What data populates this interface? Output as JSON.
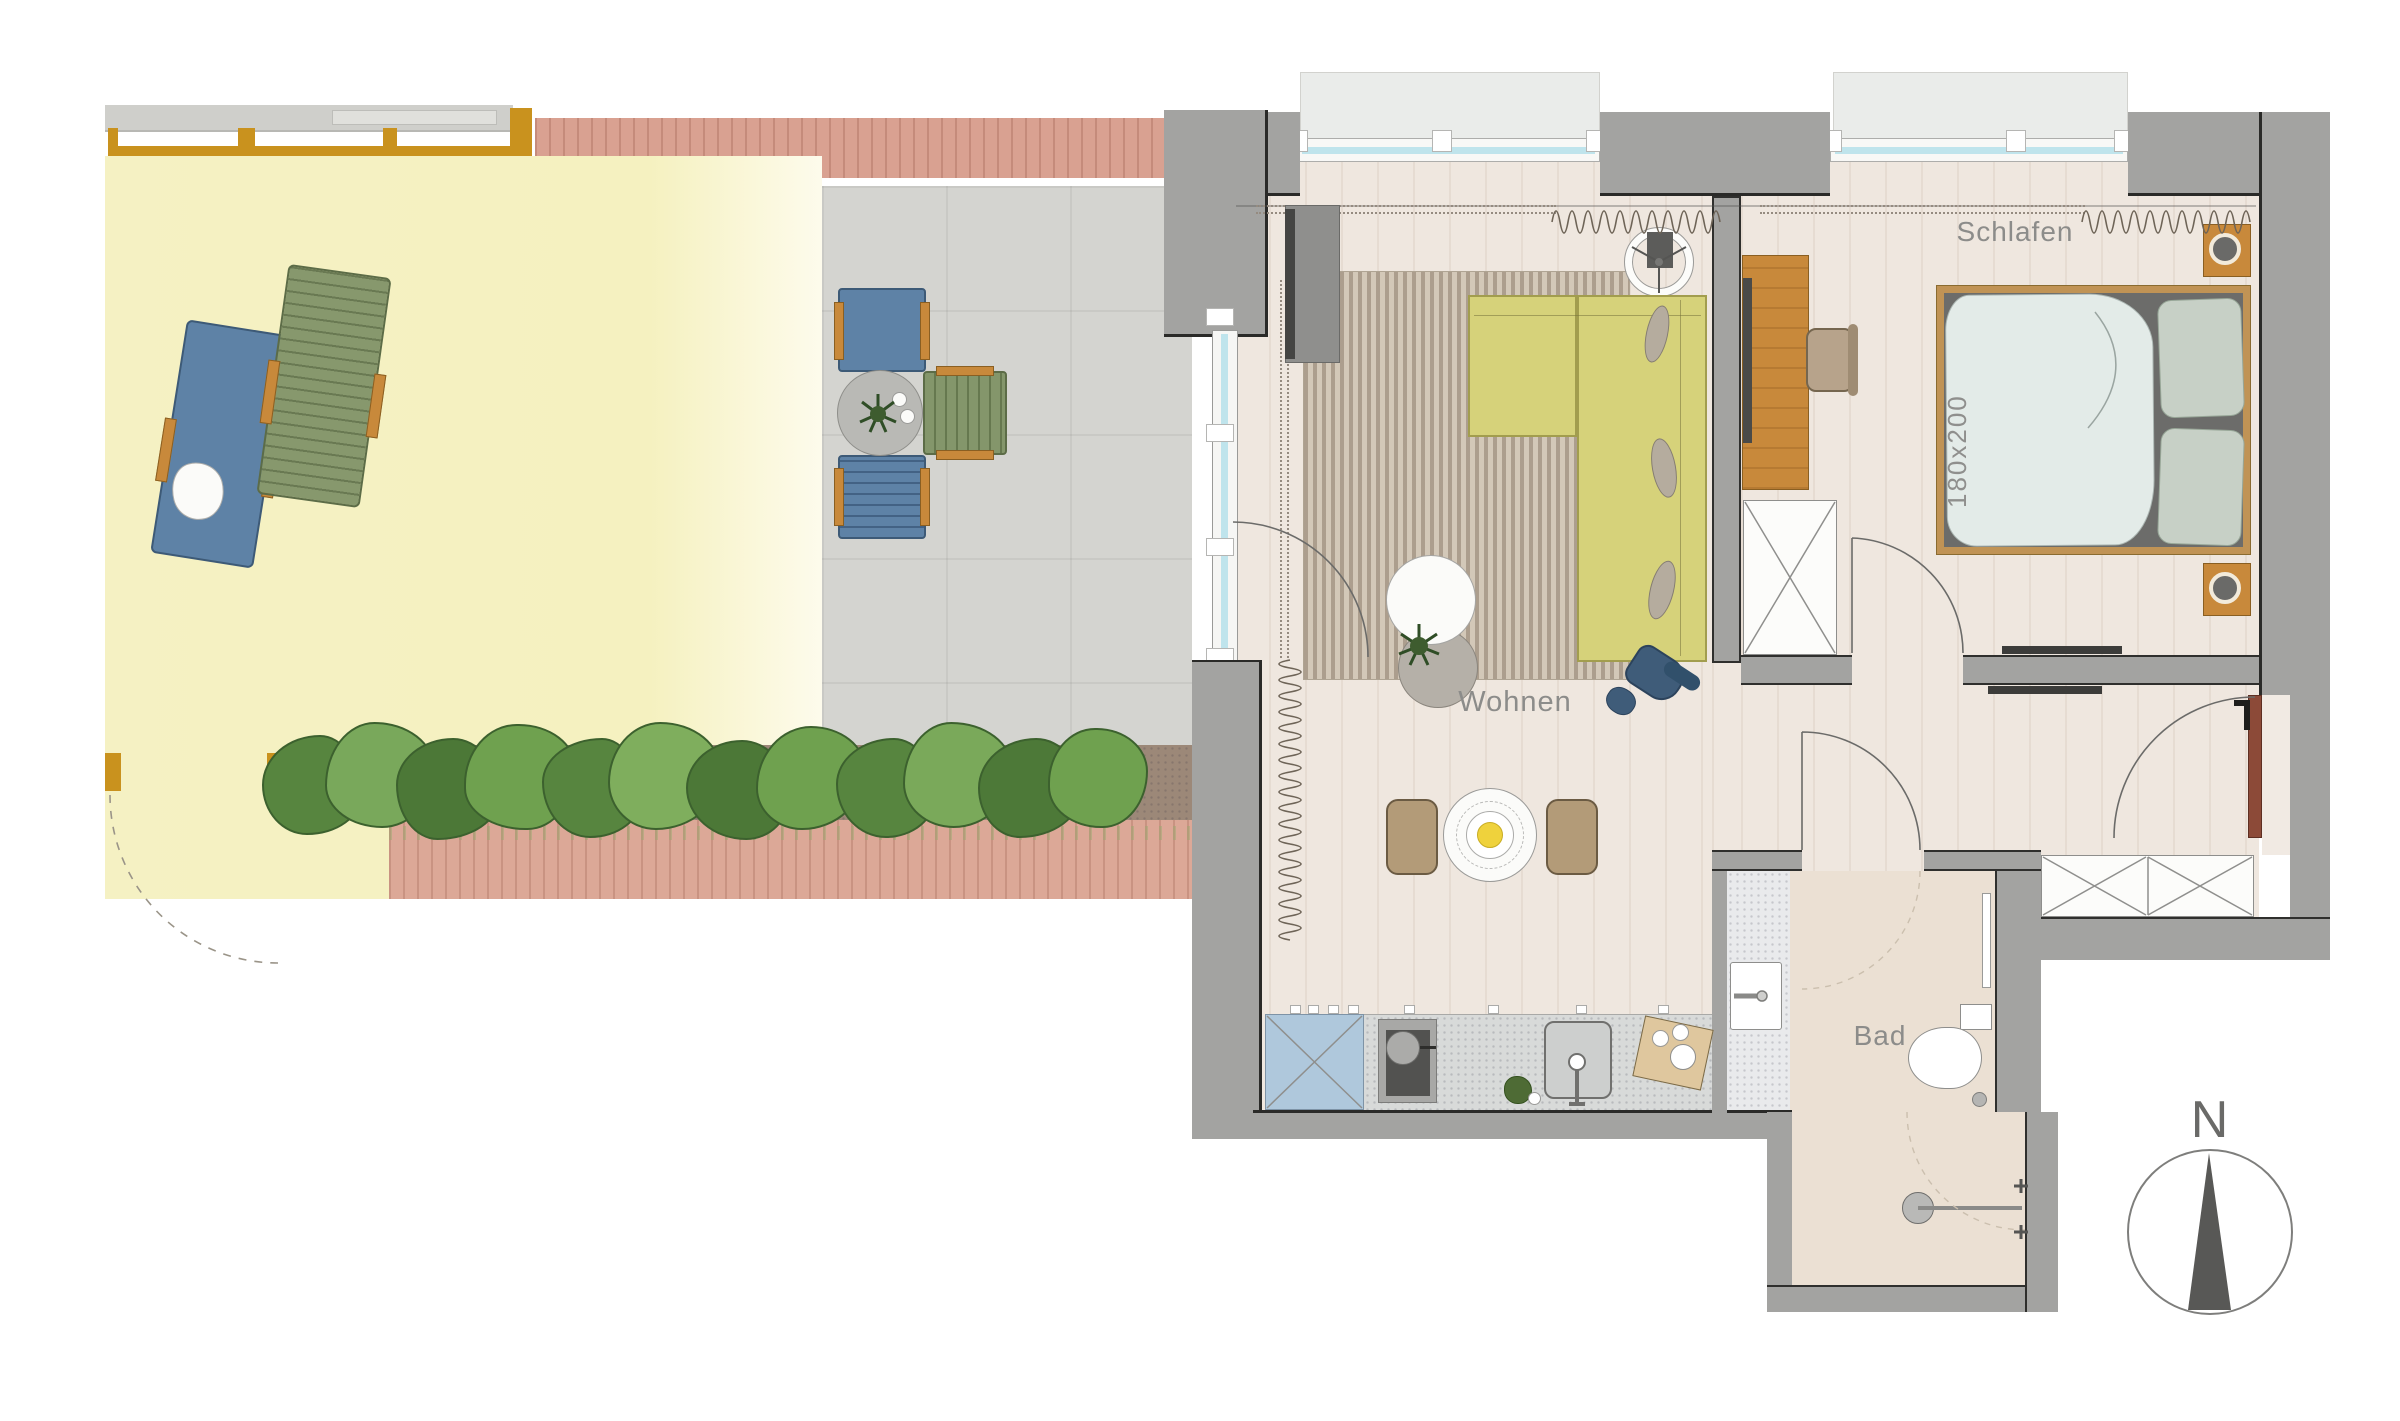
{
  "title": "Apartment floor plan with terrace",
  "labels": {
    "living": "Wohnen",
    "bedroom": "Schlafen",
    "bath": "Bad",
    "bed_size": "180x200",
    "north": "N"
  },
  "palette": {
    "lawn": "#F5F1C3",
    "deck": "#D9A191",
    "patio": "#D4D4D0",
    "soil": "#9C8878",
    "hedge_dark": "#4C7837",
    "hedge_light": "#79A85B",
    "wall_gray": "#A3A3A1",
    "wood_floor": "#EFE7DF",
    "rug": "#C6BAAA",
    "sofa_yellow": "#D6D27A",
    "pergola_mustard": "#C9921E",
    "furniture_wood": "#C8893B",
    "chair_blue": "#5E82A6",
    "chair_green": "#84966B",
    "armchair_navy": "#3F5C79",
    "dining_chair_tan": "#B39B78",
    "pendant_yellow": "#EFD23C",
    "entry_door": "#8C4A38",
    "duvet": "#E3EBE8",
    "pillow_sage": "#C7D0C6",
    "glass": "#BFE4EC"
  }
}
